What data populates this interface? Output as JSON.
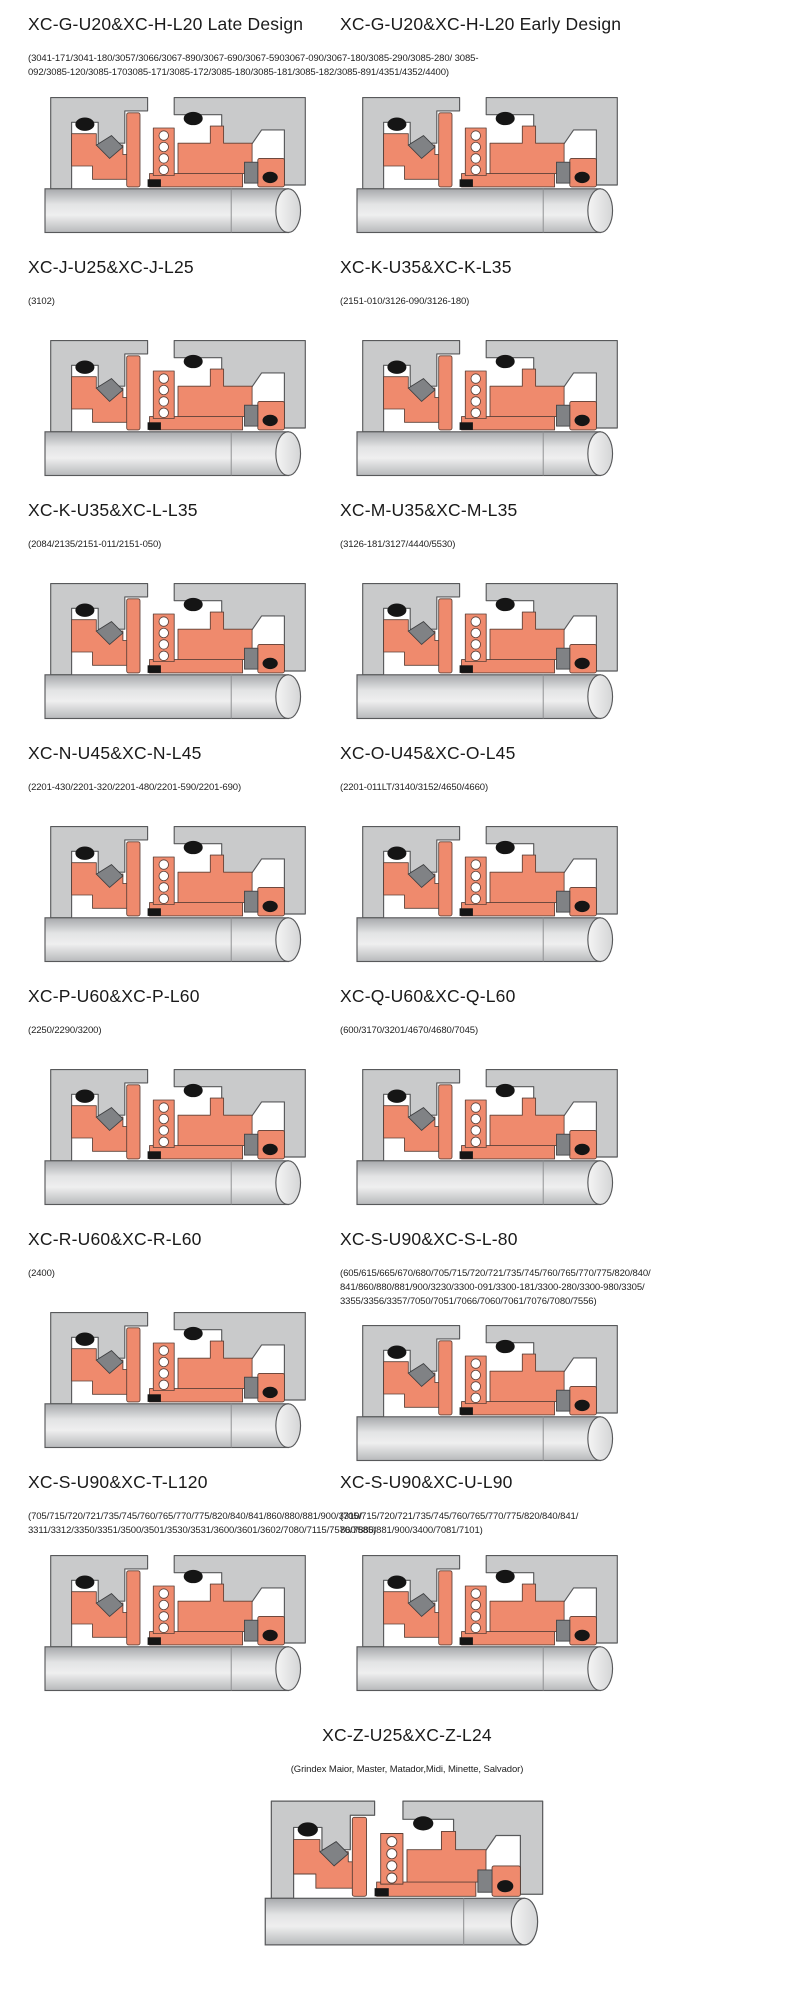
{
  "sections": [
    {
      "title": "XC-G-U20&XC-H-L20 Late Design",
      "codes": "(3041-171/3041-180/3057/3066/3067-890/3067-690/3067-5903067-090/3067-180/3085-290/3085-280/ 3085-092/3085-120/3085-1703085-171/3085-172/3085-180/3085-181/3085-182/3085-891/4351/4352/4400)"
    },
    {
      "title": "XC-G-U20&XC-H-L20 Early Design",
      "codes": ""
    },
    {
      "title": "XC-J-U25&XC-J-L25",
      "codes": "(3102)"
    },
    {
      "title": "XC-K-U35&XC-K-L35",
      "codes": "(2151-010/3126-090/3126-180)"
    },
    {
      "title": "XC-K-U35&XC-L-L35",
      "codes": "(2084/2135/2151-011/2151-050)"
    },
    {
      "title": "XC-M-U35&XC-M-L35",
      "codes": "(3126-181/3127/4440/5530)"
    },
    {
      "title": "XC-N-U45&XC-N-L45",
      "codes": "(2201-430/2201-320/2201-480/2201-590/2201-690)"
    },
    {
      "title": "XC-O-U45&XC-O-L45",
      "codes": "(2201-011LT/3140/3152/4650/4660)"
    },
    {
      "title": "XC-P-U60&XC-P-L60",
      "codes": "(2250/2290/3200)"
    },
    {
      "title": "XC-Q-U60&XC-Q-L60",
      "codes": "(600/3170/3201/4670/4680/7045)"
    },
    {
      "title": "XC-R-U60&XC-R-L60",
      "codes": "(2400)"
    },
    {
      "title": "XC-S-U90&XC-S-L-80",
      "codes": "(605/615/665/670/680/705/715/720/721/735/745/760/765/770/775/820/840/ 841/860/880/881/900/3230/3300-091/3300-181/3300-280/3300-980/3305/ 3355/3356/3357/7050/7051/7066/7060/7061/7076/7080/7556)"
    },
    {
      "title": "XC-S-U90&XC-T-L120",
      "codes": "(705/715/720/721/735/745/760/765/770/775/820/840/841/860/880/881/900/3310/ 3311/3312/3350/3351/3500/3501/3530/3531/3600/3601/3602/7080/7115/7570/7585)"
    },
    {
      "title": "XC-S-U90&XC-U-L90",
      "codes": "(705/715/720/721/735/745/760/765/770/775/820/840/841/ 860/880/881/900/3400/7081/7101)"
    },
    {
      "title": "XC-Z-U25&XC-Z-L24",
      "codes": "(Grindex  Maior, Master, Matador,Midi, Minette, Salvador)"
    }
  ],
  "diagram": {
    "icon": "mechanical-seal-cross-section",
    "colors": {
      "housing": "#c9cacb",
      "outline": "#58595b",
      "seal_orange": "#ef8a6d",
      "seal_outline": "#5d4037",
      "rubber_black": "#151515",
      "metal_gray": "#808285",
      "metal_outline": "#3f4042",
      "spring_coil": "#ffffff"
    }
  }
}
